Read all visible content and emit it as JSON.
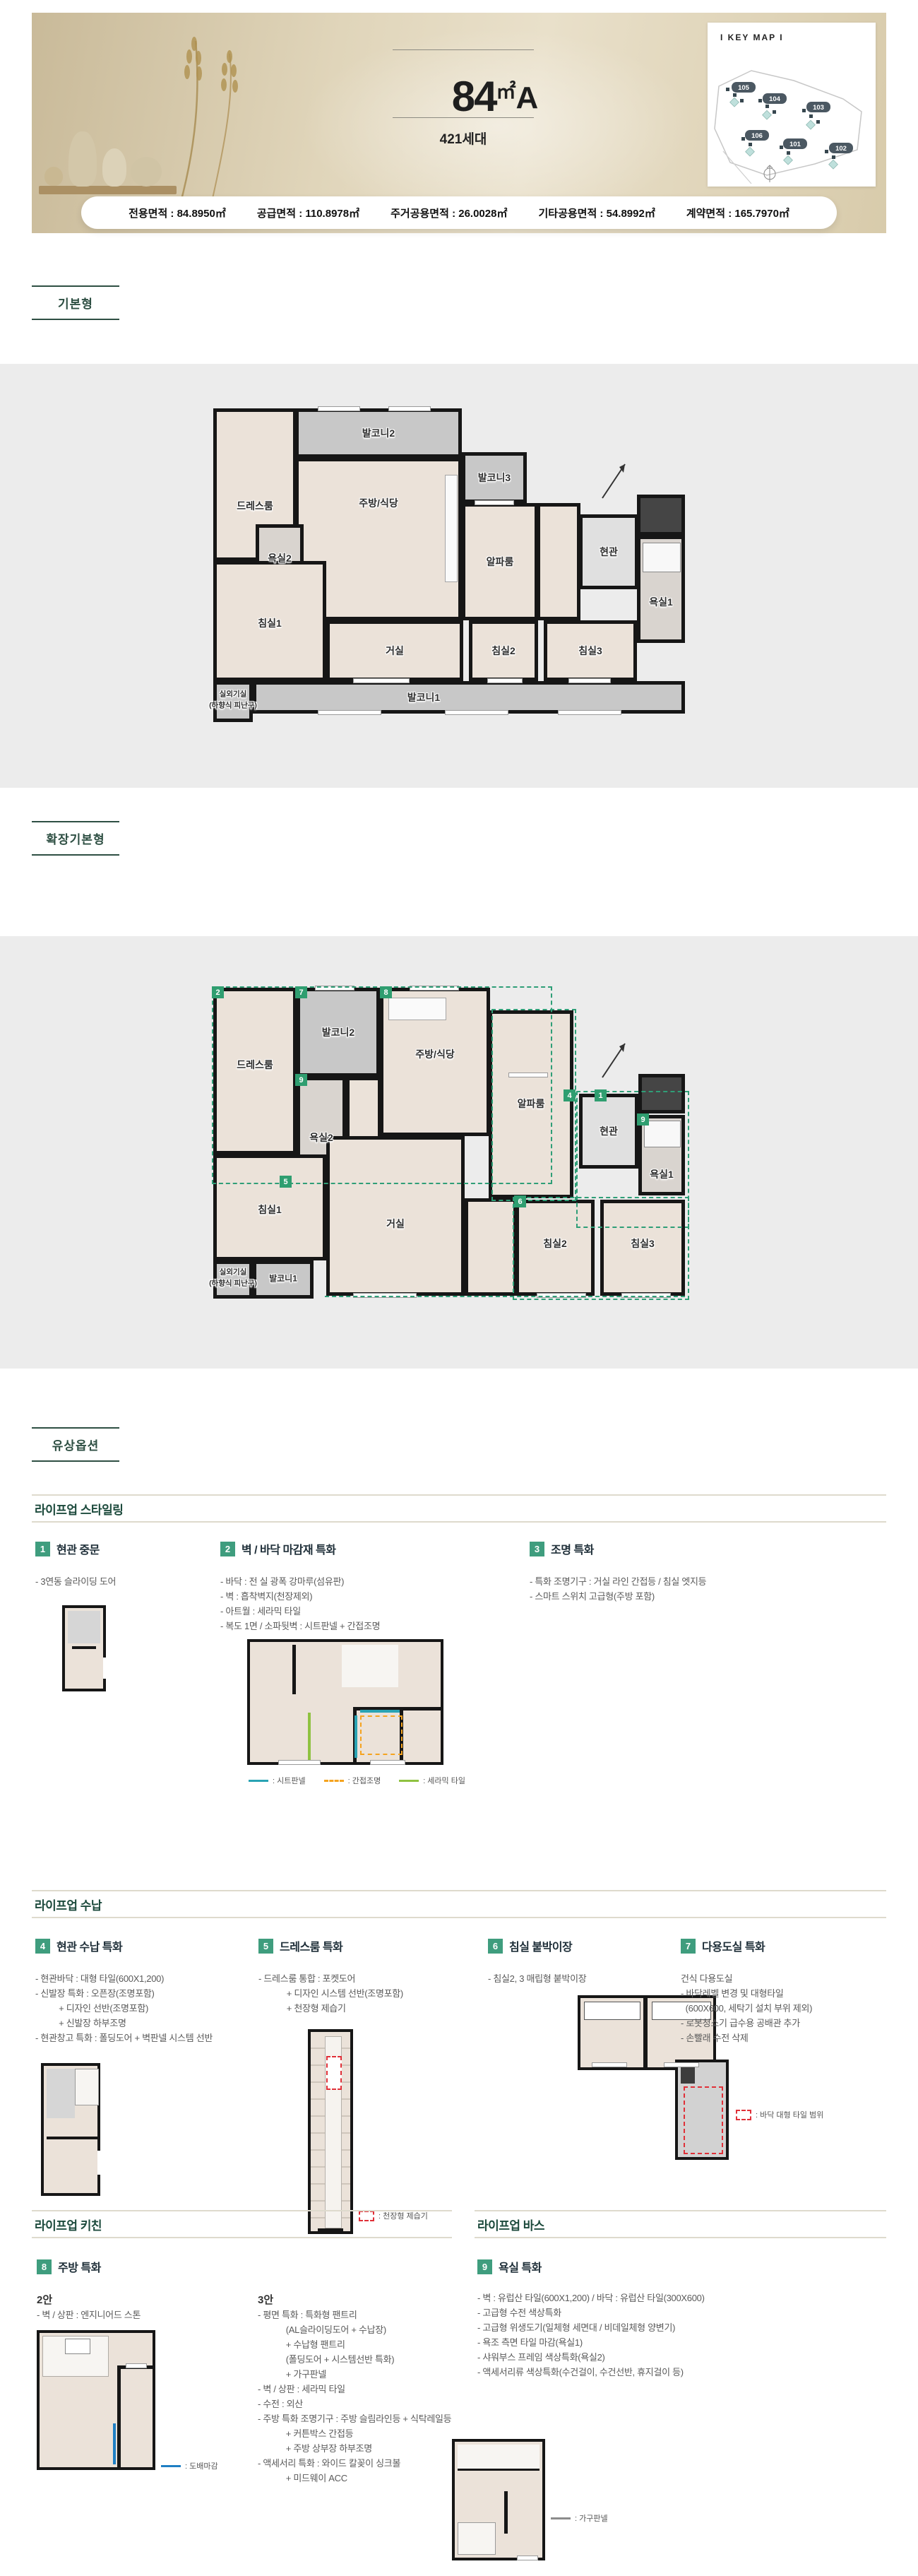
{
  "header": {
    "title": {
      "num": "84",
      "unit": "㎡",
      "suffix": "A"
    },
    "households": "421세대",
    "keymap": {
      "title": "I KEY MAP I",
      "buildings": [
        "105",
        "104",
        "103",
        "106",
        "101",
        "102"
      ]
    }
  },
  "area_info": {
    "items": [
      {
        "text": "전용면적 : 84.8950㎡"
      },
      {
        "text": "공급면적 : 110.8978㎡"
      },
      {
        "text": "주거공용면적 : 26.0028㎡"
      },
      {
        "text": "기타공용면적 : 54.8992㎡"
      },
      {
        "text": "계약면적 : 165.7970㎡"
      }
    ]
  },
  "plan_basic": {
    "label": "기본형",
    "rooms": {
      "balcony2": "발코니2",
      "dressroom": "드레스룸",
      "bath2": "욕실2",
      "kitchen": "주방/식당",
      "balcony3": "발코니3",
      "alpha": "알파룸",
      "entrance": "현관",
      "bath1": "욕실1",
      "bed1": "침실1",
      "living": "거실",
      "bed2": "침실2",
      "bed3": "침실3",
      "balcony1": "발코니1",
      "outdoor": "실외기실",
      "outdoor_sub": "(하향식 피난구)"
    }
  },
  "plan_ext": {
    "label": "확장기본형",
    "rooms": {
      "dressroom": "드레스룸",
      "balcony2": "발코니2",
      "kitchen": "주방/식당",
      "alpha": "알파룸",
      "entrance": "현관",
      "bath2": "욕실2",
      "bath1": "욕실1",
      "bed1": "침실1",
      "living": "거실",
      "bed2": "침실2",
      "bed3": "침실3",
      "balcony1": "발코니1",
      "outdoor": "실외기실",
      "outdoor_sub": "(하향식 피난구)"
    },
    "badges": {
      "b2": "2",
      "b7": "7",
      "b8": "8",
      "b9a": "9",
      "b5": "5",
      "b4": "4",
      "b1": "1",
      "b9b": "9",
      "b6": "6"
    }
  },
  "paid_options_label": "유상옵션",
  "styling": {
    "title": "라이프업 스타일링",
    "items": [
      {
        "num": "1",
        "title": "현관 중문",
        "details": "- 3연동 슬라이딩 도어"
      },
      {
        "num": "2",
        "title": "벽 / 바닥 마감재 특화",
        "details": "- 바닥 : 전 실 광폭 강마루(섬유판)\n- 벽 : 흡착벽지(천장제외)\n- 아트월 : 세라믹 타일\n- 복도 1면 / 소파뒷벽 : 시트판넬 + 간접조명",
        "legend": [
          {
            "label": ": 시트판넬",
            "color": "#29a3b4",
            "style": "solid"
          },
          {
            "label": ": 간접조명",
            "color": "#f5a31f",
            "style": "dashed"
          },
          {
            "label": ": 세라믹 타일",
            "color": "#8fc241",
            "style": "solid"
          }
        ]
      },
      {
        "num": "3",
        "title": "조명 특화",
        "details": "- 특화 조명기구 : 거실 라인 간접등 / 침실 엣지등\n- 스마트 스위치 고급형(주방 포함)"
      }
    ]
  },
  "storage": {
    "title": "라이프업 수납",
    "items": [
      {
        "num": "4",
        "title": "현관 수납 특화",
        "details": "- 현관바닥 : 대형 타일(600X1,200)\n- 신발장 특화 : 오픈장(조명포함)\n          + 디자인 선반(조명포함)\n          + 신발장 하부조명\n- 현관창고 특화 : 폴딩도어 + 벽판넬 시스템 선반"
      },
      {
        "num": "5",
        "title": "드레스룸 특화",
        "details": "- 드레스룸 통합 : 포켓도어\n            + 디자인 시스템 선반(조명포함)\n            + 천장형 제습기",
        "legend": ": 천장형 제습기"
      },
      {
        "num": "6",
        "title": "침실 붙박이장",
        "details": "- 침실2, 3 매립형 붙박이장"
      },
      {
        "num": "7",
        "title": "다용도실 특화",
        "details": "건식 다용도실\n- 바닥레벨 변경 및 대형타일\n  (600X600, 세탁기 설치 부위 제외)\n- 로봇청소기 급수용 공배관 추가\n- 손빨래 수전 삭제",
        "legend": ": 바닥 대형 타일 범위"
      }
    ]
  },
  "kitchen": {
    "title": "라이프업 키친",
    "num": "8",
    "item_title": "주방 특화",
    "plan2": {
      "label": "2안",
      "details": "- 벽 / 상판 : 엔지니어드 스톤",
      "legend": ": 도배마감"
    },
    "plan3": {
      "label": "3안",
      "details": "- 평면 특화 : 특화형 팬트리\n            (AL슬라이딩도어 + 수납장)\n            + 수납형 팬트리\n            (폴딩도어 + 시스템선반 특화)\n            + 가구판넬\n- 벽 / 상판 : 세라믹 타일\n- 수전 : 외산\n- 주방 특화 조명기구 : 주방 슬림라인등 + 식탁레일등\n            + 커튼박스 간접등\n            + 주방 상부장 하부조명\n- 액세서리 특화 : 와이드 칼꽂이 싱크볼\n            + 미드웨이 ACC",
      "legend": ": 가구판넬"
    }
  },
  "bath": {
    "title": "라이프업 바스",
    "num": "9",
    "item_title": "욕실 특화",
    "details": "- 벽 : 유럽산 타일(600X1,200) / 바닥 : 유럽산 타일(300X600)\n- 고급형 수전 색상특화\n- 고급형 위생도기(일체형 세면대 / 비데일체형 양변기)\n- 욕조 측면 타일 마감(욕실1)\n- 샤워부스 프레임 색상특화(욕실2)\n- 액세서리류 색상특화(수건걸이, 수건선반, 휴지걸이 등)"
  },
  "colors": {
    "section_green": "#2e4f43",
    "item_badge_green": "#3f9d7e",
    "plan_badge_green": "#2f9e70",
    "dashed_green": "#2f9e77",
    "legend_teal": "#29a3b4",
    "legend_orange": "#f5a31f",
    "legend_lime": "#8fc241",
    "legend_red": "#e03038",
    "legend_blue": "#1f7fc4",
    "plan_floor": "#ebe2d9",
    "plan_balcony": "#c8c8c8",
    "gray_band": "#ececec"
  }
}
